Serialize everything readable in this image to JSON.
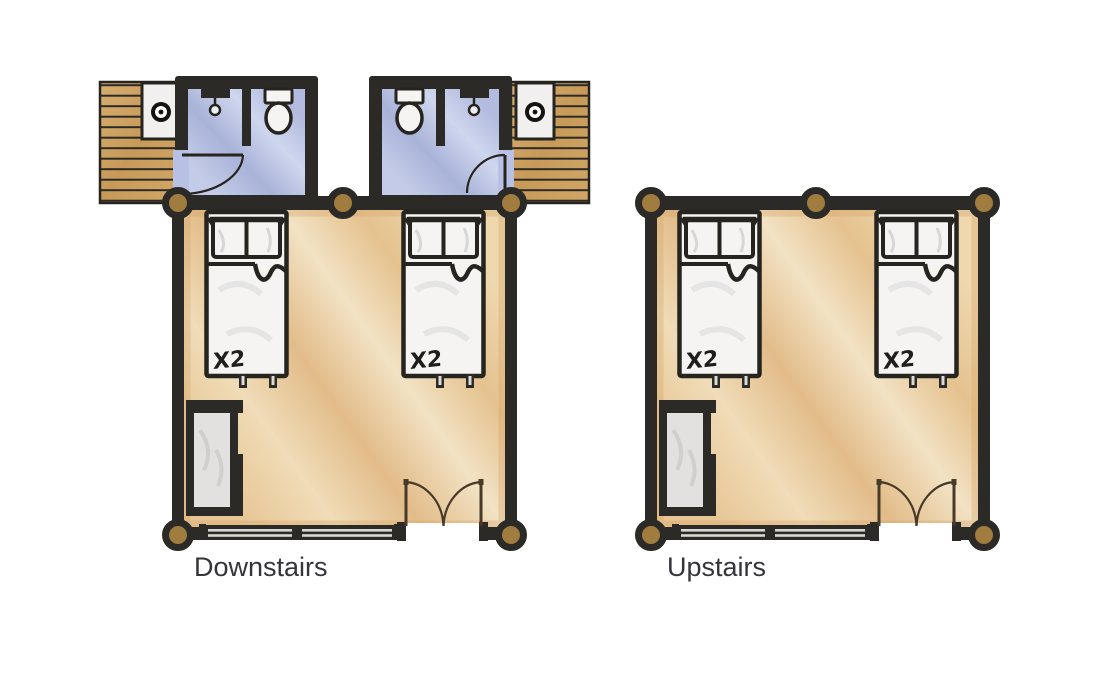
{
  "page": {
    "background": "#ffffff"
  },
  "plan": {
    "bed_capacity_label": "X2",
    "units": [
      {
        "id": "downstairs",
        "label": "Downstairs",
        "beds": 2,
        "bathrooms": 2,
        "decks": 2,
        "wardrobes": 1,
        "double_doors": 1,
        "windows": 1
      },
      {
        "id": "upstairs",
        "label": "Upstairs",
        "beds": 2,
        "bathrooms": 0,
        "decks": 0,
        "wardrobes": 1,
        "double_doors": 1,
        "windows": 1
      }
    ],
    "icons": [
      "corner-post",
      "water-heater",
      "toilet",
      "shower-head",
      "door-swing",
      "bed",
      "pillow",
      "wardrobe",
      "window",
      "wood-deck",
      "double-door"
    ]
  },
  "colors": {
    "wall": "#2b2a27",
    "ink": "#26241f",
    "post": "#a07c3e",
    "door_line": "#473a28",
    "wood": "#cda25f",
    "bath_floor": "#b0badf",
    "room_floor": "#e9cfa0",
    "furniture_white": "#f5f4f2",
    "wardrobe_interior": "#e2e1df",
    "glass": "#d8d8d2",
    "label_text": "#34343a"
  }
}
